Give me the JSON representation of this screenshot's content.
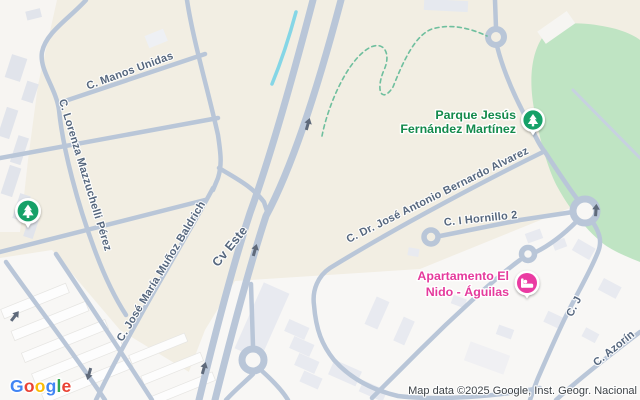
{
  "map": {
    "street_labels": {
      "manos_unidas": "C. Manos Unidas",
      "lorenza": "C. Lorenza Mazzuchelli Pérez",
      "munoz_baldrich": "C. José María Muñoz Baldrich",
      "cv_este": "Cv Este",
      "bernardo_alvarez": "C. Dr. José Antonio Bernardo Alvarez",
      "hornillo": "C. I Hornillo 2",
      "c_j": "C. J",
      "azorin": "C. Azorín"
    },
    "pois": {
      "park": {
        "name_line1": "Parque Jesús",
        "name_line2": "Fernández Martínez",
        "label_color": "#138a4c",
        "marker_color": "#12a168",
        "icon": "tree-icon"
      },
      "apartment": {
        "name_line1": "Apartamento El",
        "name_line2": "Nido - Águilas",
        "label_color": "#e53a9c",
        "marker_color": "#ea3aa2",
        "icon": "bed-icon"
      },
      "standalone_tree_marker": {
        "icon": "tree-icon",
        "marker_color": "#12a168"
      }
    },
    "attribution": "Map data ©2025 Google, Inst. Geogr. Nacional",
    "logo": {
      "letters": [
        {
          "char": "G",
          "color": "#4285F4"
        },
        {
          "char": "o",
          "color": "#EA4335"
        },
        {
          "char": "o",
          "color": "#FBBC05"
        },
        {
          "char": "g",
          "color": "#4285F4"
        },
        {
          "char": "l",
          "color": "#34A853"
        },
        {
          "char": "e",
          "color": "#EA4335"
        }
      ]
    },
    "colors": {
      "background": "#f2eee3",
      "urban_zone": "#f8f7f5",
      "industrial_zone": "#f7f5f2",
      "park_green": "#bfe4c3",
      "road": "#b9c6d8",
      "water": "#85d6e6",
      "street_label": "#56677e",
      "trail_dash": "#6fbf9e",
      "one_way_arrow": "#5f6a7b"
    }
  }
}
